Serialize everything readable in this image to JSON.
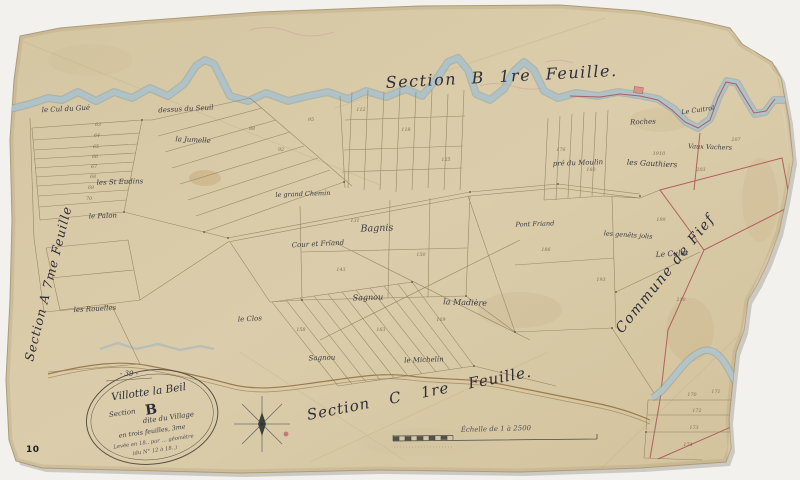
{
  "sheet": {
    "page_stamp": "10",
    "folio_number": "- 39 -"
  },
  "titles": {
    "top_neighbor": "Section B 1re Feuille.",
    "bottom_neighbor": "Section C 1re Feuille.",
    "left_neighbor": "Section A 7me Feuille",
    "right_neighbor": "Commune de Fief"
  },
  "cartouche": {
    "line1": "Villotte la Beil",
    "line2_label": "Section",
    "line2_letter": "B",
    "line3": "dite du Village",
    "line4": "en trois feuilles, 3me",
    "line5": "Levée en 18.. par … géomètre",
    "line6": "(du N° 12 à 18..)"
  },
  "scale_bar": {
    "label": "Échelle de 1 à 2500"
  },
  "place_labels": [
    "le Cul du Gué",
    "dessus du Seuil",
    "la Jumelle",
    "les St Eudins",
    "le Palon",
    "le grand Chemin",
    "Cour et Friand",
    "Bagnis",
    "Sagnou",
    "Sagnou",
    "le Clos",
    "la Madière",
    "le Michelin",
    "Roches",
    "pré du Moulin",
    "les Gauthiers",
    "Pont Friand",
    "les genêts jolis",
    "Le Culot",
    "Vaux Vachers",
    "Le Cuitrol",
    "les Rouelles"
  ],
  "parcel_numbers": [
    "63",
    "64",
    "65",
    "66",
    "67",
    "68",
    "69",
    "70",
    "88",
    "92",
    "95",
    "112",
    "118",
    "125",
    "131",
    "143",
    "150",
    "158",
    "163",
    "169",
    "176",
    "180",
    "186",
    "193",
    "199",
    "203",
    "207",
    "210",
    "1910",
    "170",
    "171",
    "172",
    "173",
    "174"
  ],
  "colors": {
    "background": "#f2f1ee",
    "paper": "#d7c8a5",
    "river": "#9db5bd",
    "parcel_line": "#8d7c58",
    "red_boundary": "#a84f4f",
    "ink": "#3a3a44"
  }
}
